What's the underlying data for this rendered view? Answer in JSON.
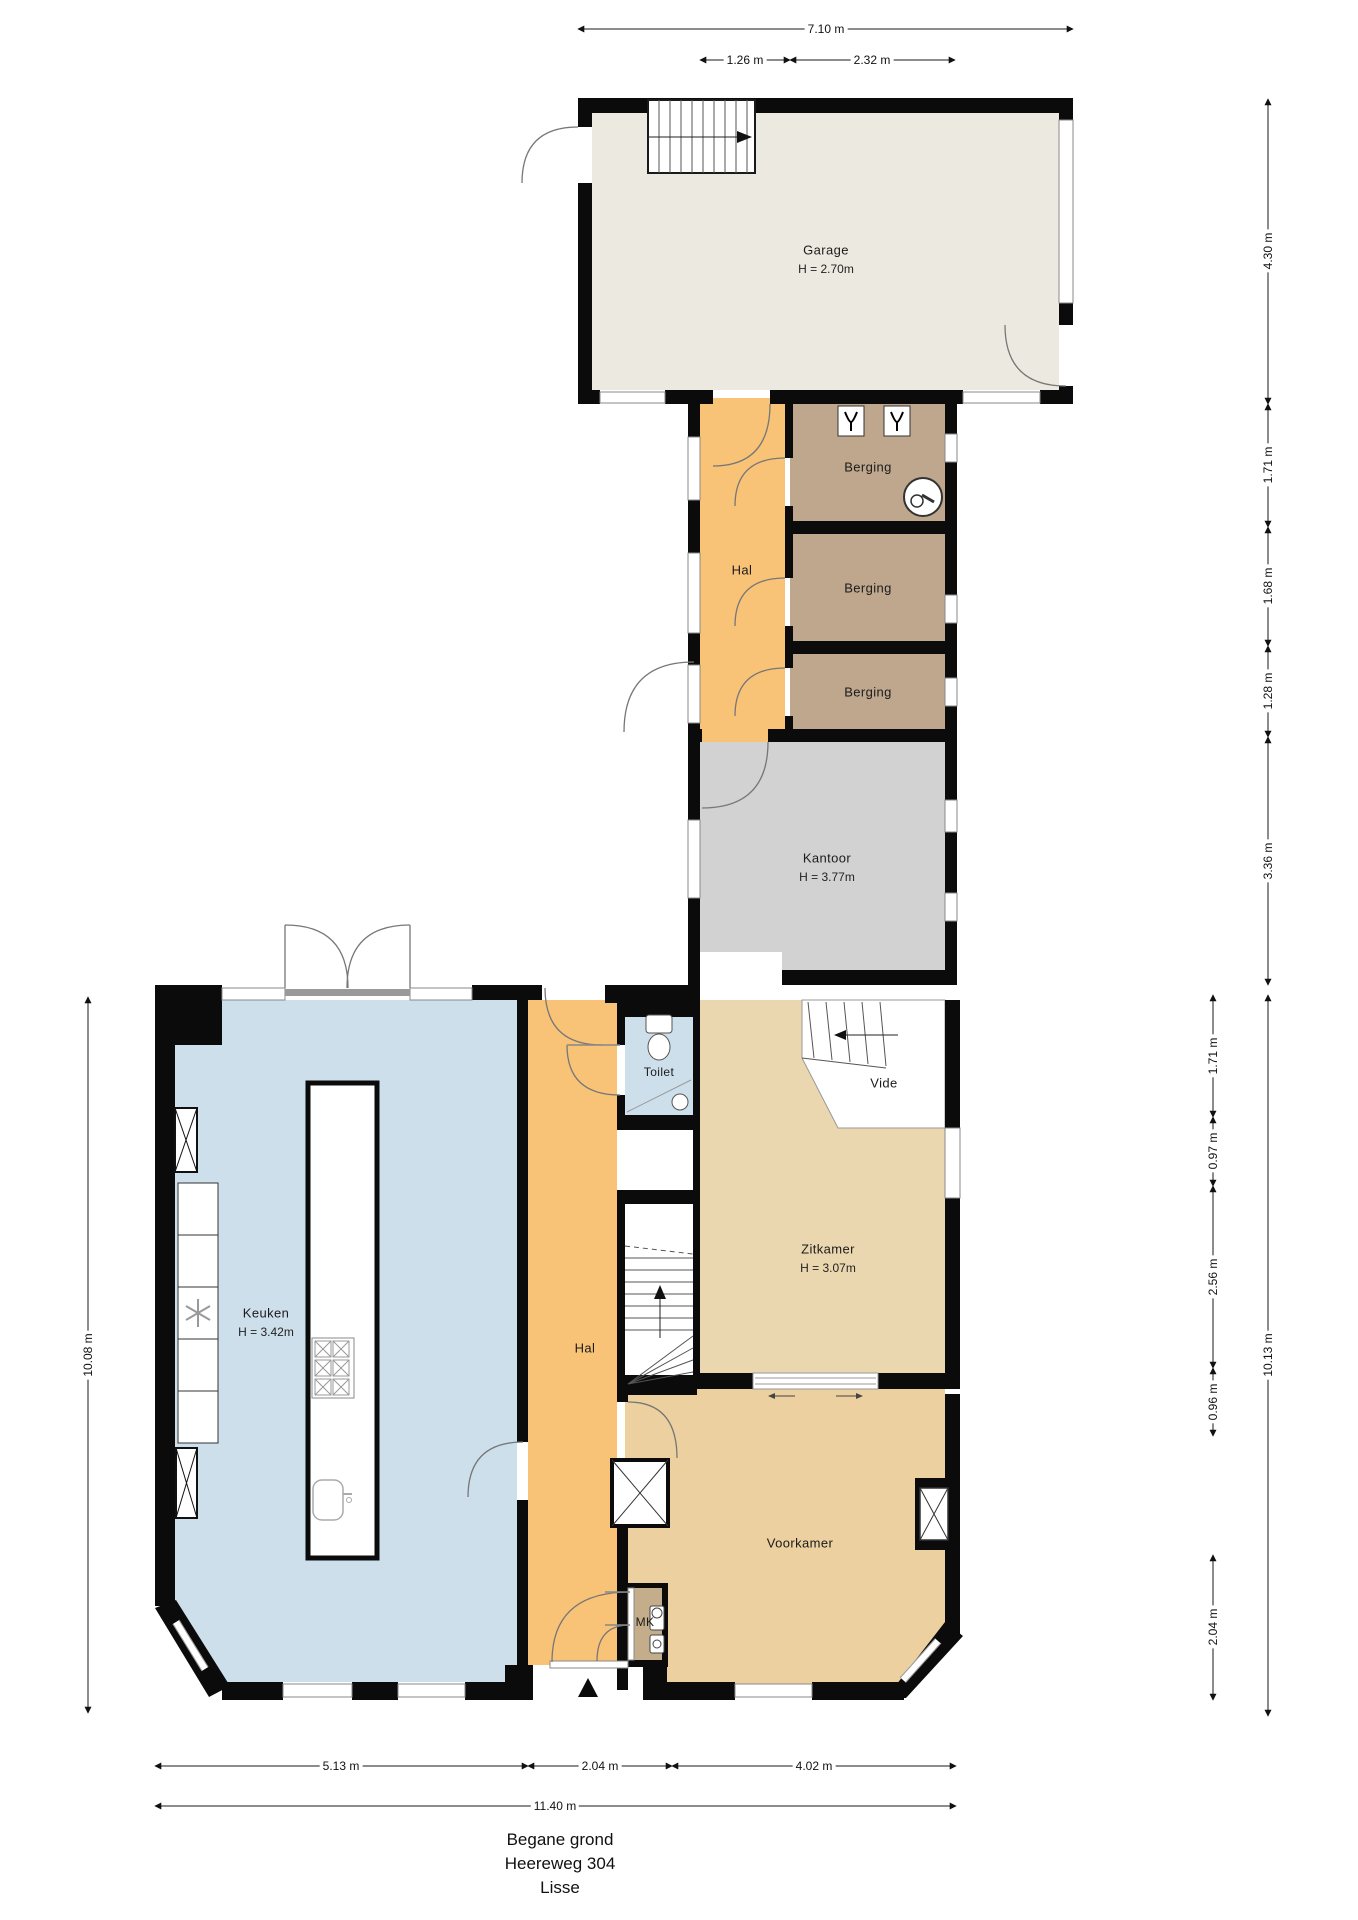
{
  "palette": {
    "wall": "#0B0B0B",
    "garage": "#ECEAE0",
    "hal": "#F8C377",
    "berging": "#BEA78D",
    "kantoor": "#D2D2D2",
    "keuken": "#CEDFEC",
    "toilet": "#CEDFEC",
    "zitkamer": "#EAD7AF",
    "voorkamer": "#ECD0A0",
    "mk": "#C4AD8B",
    "vide": "#FFFFFF"
  },
  "rooms": {
    "garage": {
      "label": "Garage",
      "height": "H = 2.70m"
    },
    "hal_boven": {
      "label": "Hal"
    },
    "berging_1": {
      "label": "Berging"
    },
    "berging_2": {
      "label": "Berging"
    },
    "berging_3": {
      "label": "Berging"
    },
    "kantoor": {
      "label": "Kantoor",
      "height": "H = 3.77m"
    },
    "keuken": {
      "label": "Keuken",
      "height": "H = 3.42m"
    },
    "hal": {
      "label": "Hal"
    },
    "toilet": {
      "label": "Toilet"
    },
    "vide": {
      "label": "Vide"
    },
    "zitkamer": {
      "label": "Zitkamer",
      "height": "H = 3.07m"
    },
    "voorkamer": {
      "label": "Voorkamer"
    },
    "mk": {
      "label": "MK"
    }
  },
  "dimensions": {
    "top_total": "7.10 m",
    "top_segments": [
      "1.26 m",
      "2.32 m"
    ],
    "right_upper": [
      "4.30 m",
      "1.71 m",
      "1.68 m",
      "1.28 m",
      "3.36 m"
    ],
    "right_lower": [
      "1.71 m",
      "0.97 m",
      "2.56 m",
      "0.96 m",
      "2.04 m"
    ],
    "right_lower_total": "10.13 m",
    "left_total": "10.08 m",
    "bottom_segments": [
      "5.13 m",
      "2.04 m",
      "4.02 m"
    ],
    "bottom_total": "11.40 m"
  },
  "title": {
    "floor": "Begane grond",
    "street": "Heereweg 304",
    "city": "Lisse"
  }
}
